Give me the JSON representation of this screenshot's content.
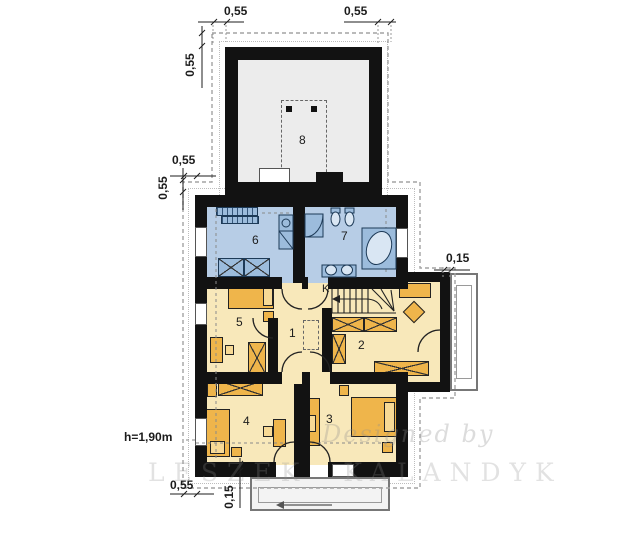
{
  "watermark": {
    "line1": "Designed by",
    "line2": "LESZEK KALANDYK"
  },
  "room_labels": [
    "1",
    "2",
    "3",
    "4",
    "5",
    "6",
    "7",
    "8"
  ],
  "stairs_label": "K",
  "dims": {
    "top_left": "0,55",
    "top_right": "0,55",
    "left_upper": "0,55",
    "left_mid_h": "0,55",
    "left_mid_v": "0,55",
    "right_balcony": "0,15",
    "bottom_left": "0,55",
    "bottom_center": "0,15",
    "headroom": "h=1,90m"
  },
  "colors": {
    "wall": "#121212",
    "room_blue": "#b7cde6",
    "fixture_blue": "#9cbcdc",
    "fixture_light": "#d9e6f3",
    "room_yellow": "#f8e8ba",
    "furniture_orange": "#efb54b",
    "furniture_light": "#f7d995",
    "room8_floor": "#ececec",
    "eave": "#a3a3a3",
    "terrace": "#f3f3f3",
    "ink": "#1c1c1c",
    "watermark": "#8f8f8f"
  }
}
